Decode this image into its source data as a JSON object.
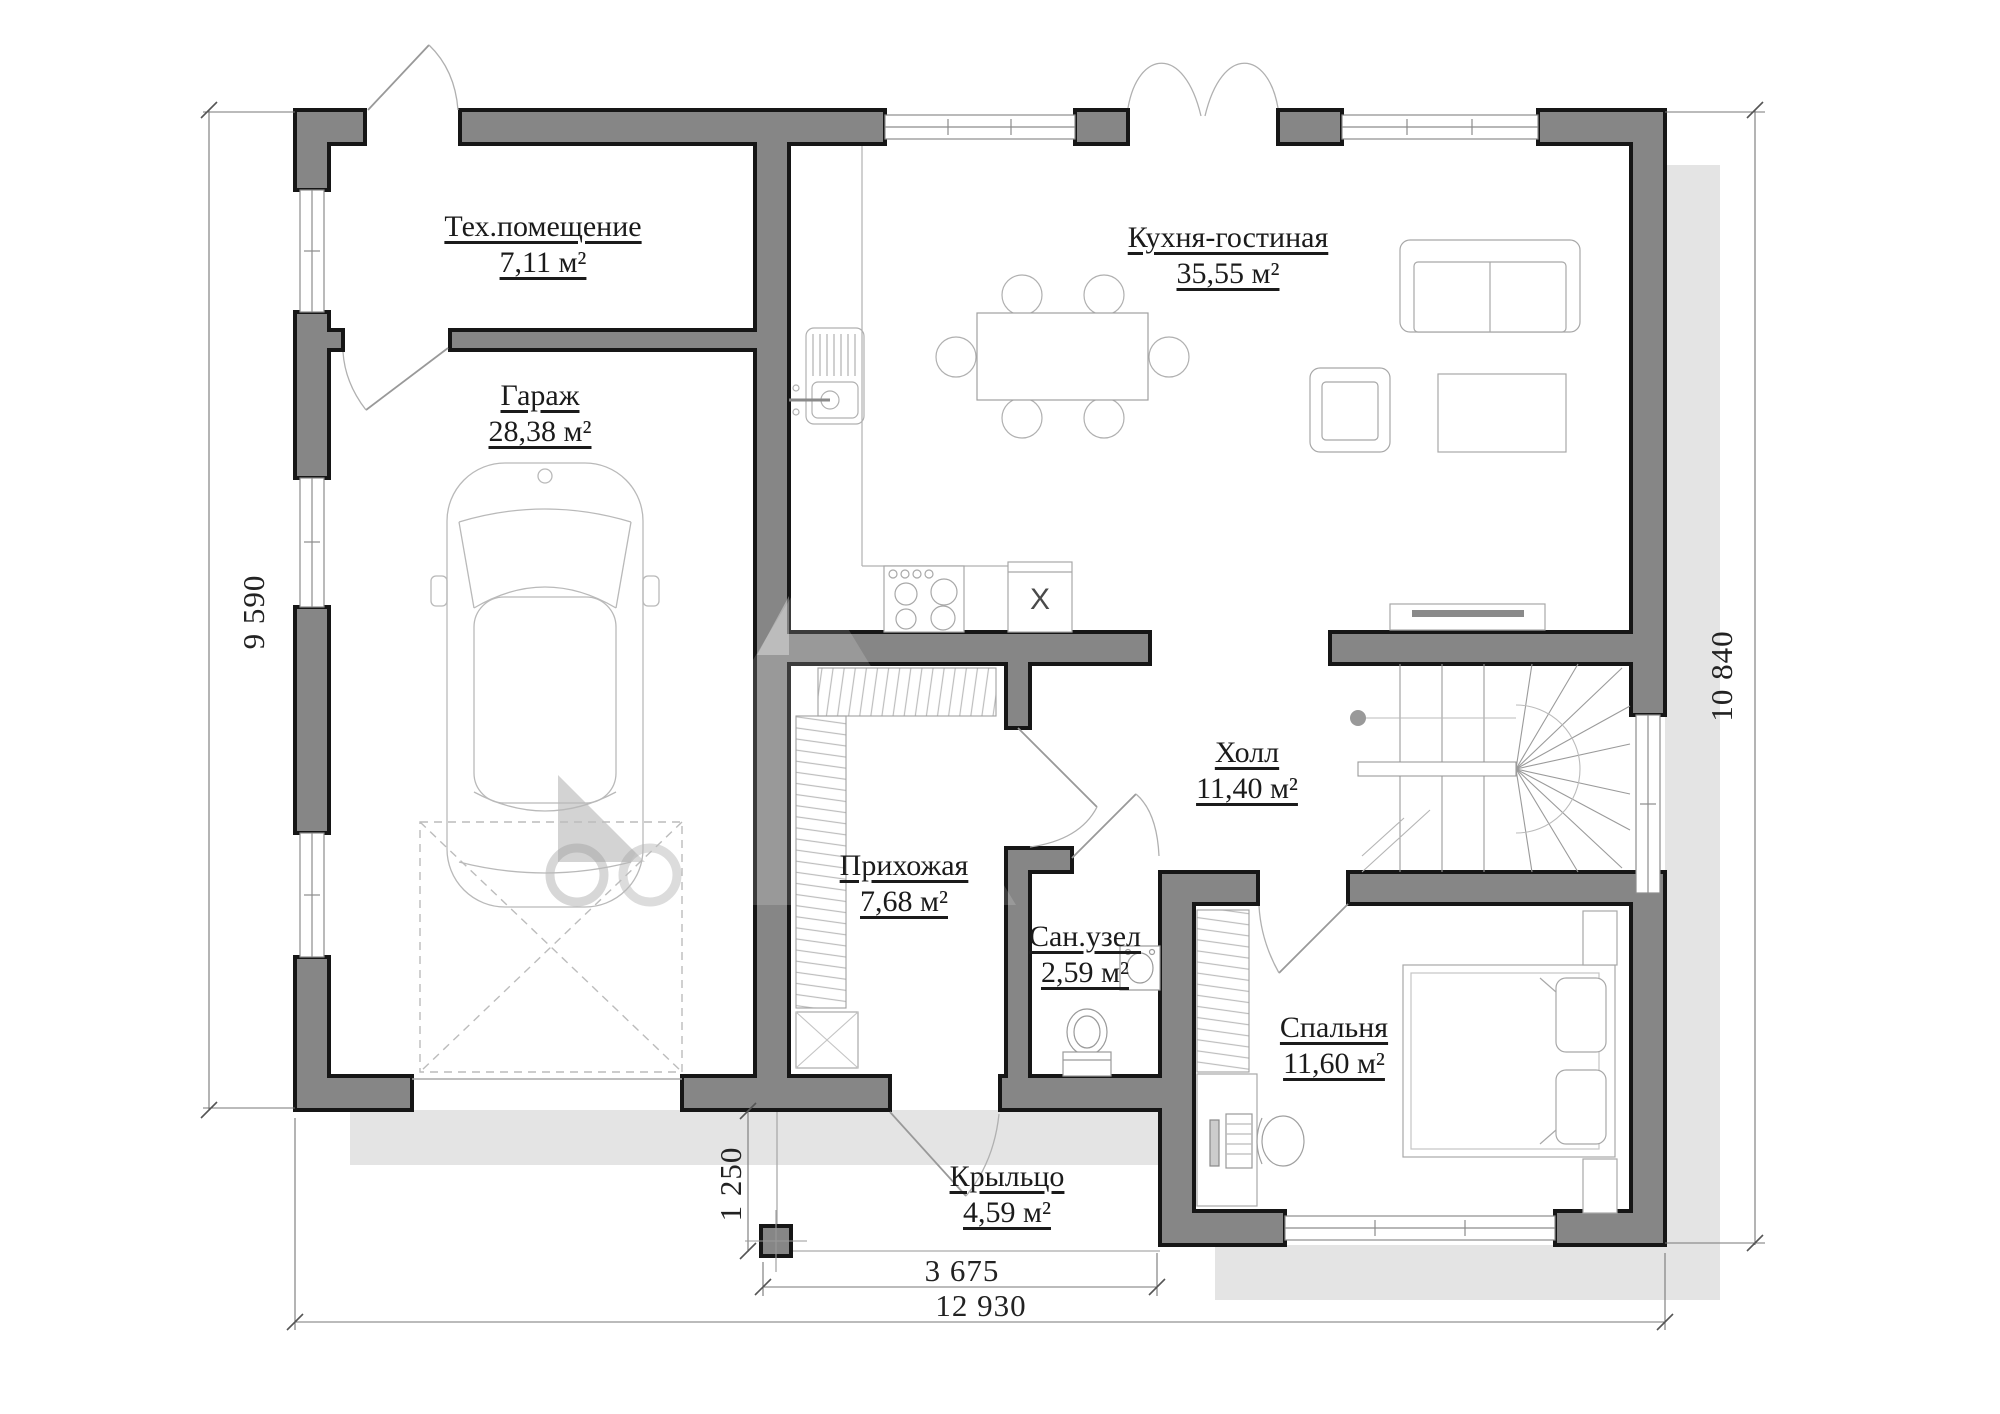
{
  "rooms": [
    {
      "name": "Тех.помещение",
      "area": "7,11 м²"
    },
    {
      "name": "Гараж",
      "area": "28,38 м²"
    },
    {
      "name": "Кухня-гостиная",
      "area": "35,55 м²"
    },
    {
      "name": "Холл",
      "area": "11,40 м²"
    },
    {
      "name": "Прихожая",
      "area": "7,68 м²"
    },
    {
      "name": "Сан.узел",
      "area": "2,59 м²"
    },
    {
      "name": "Спальня",
      "area": "11,60 м²"
    },
    {
      "name": "Крыльцо",
      "area": "4,59 м²"
    }
  ],
  "dimensions": {
    "left_height": "9 590",
    "right_height": "10 840",
    "porch_width": "3 675",
    "total_width": "12 930",
    "porch_depth": "1 250"
  },
  "fixtures": {
    "appliance_marker": "X"
  },
  "colors": {
    "wall_fill": "#868686",
    "wall_outline": "#161616",
    "shadow": "#e4e4e4"
  }
}
